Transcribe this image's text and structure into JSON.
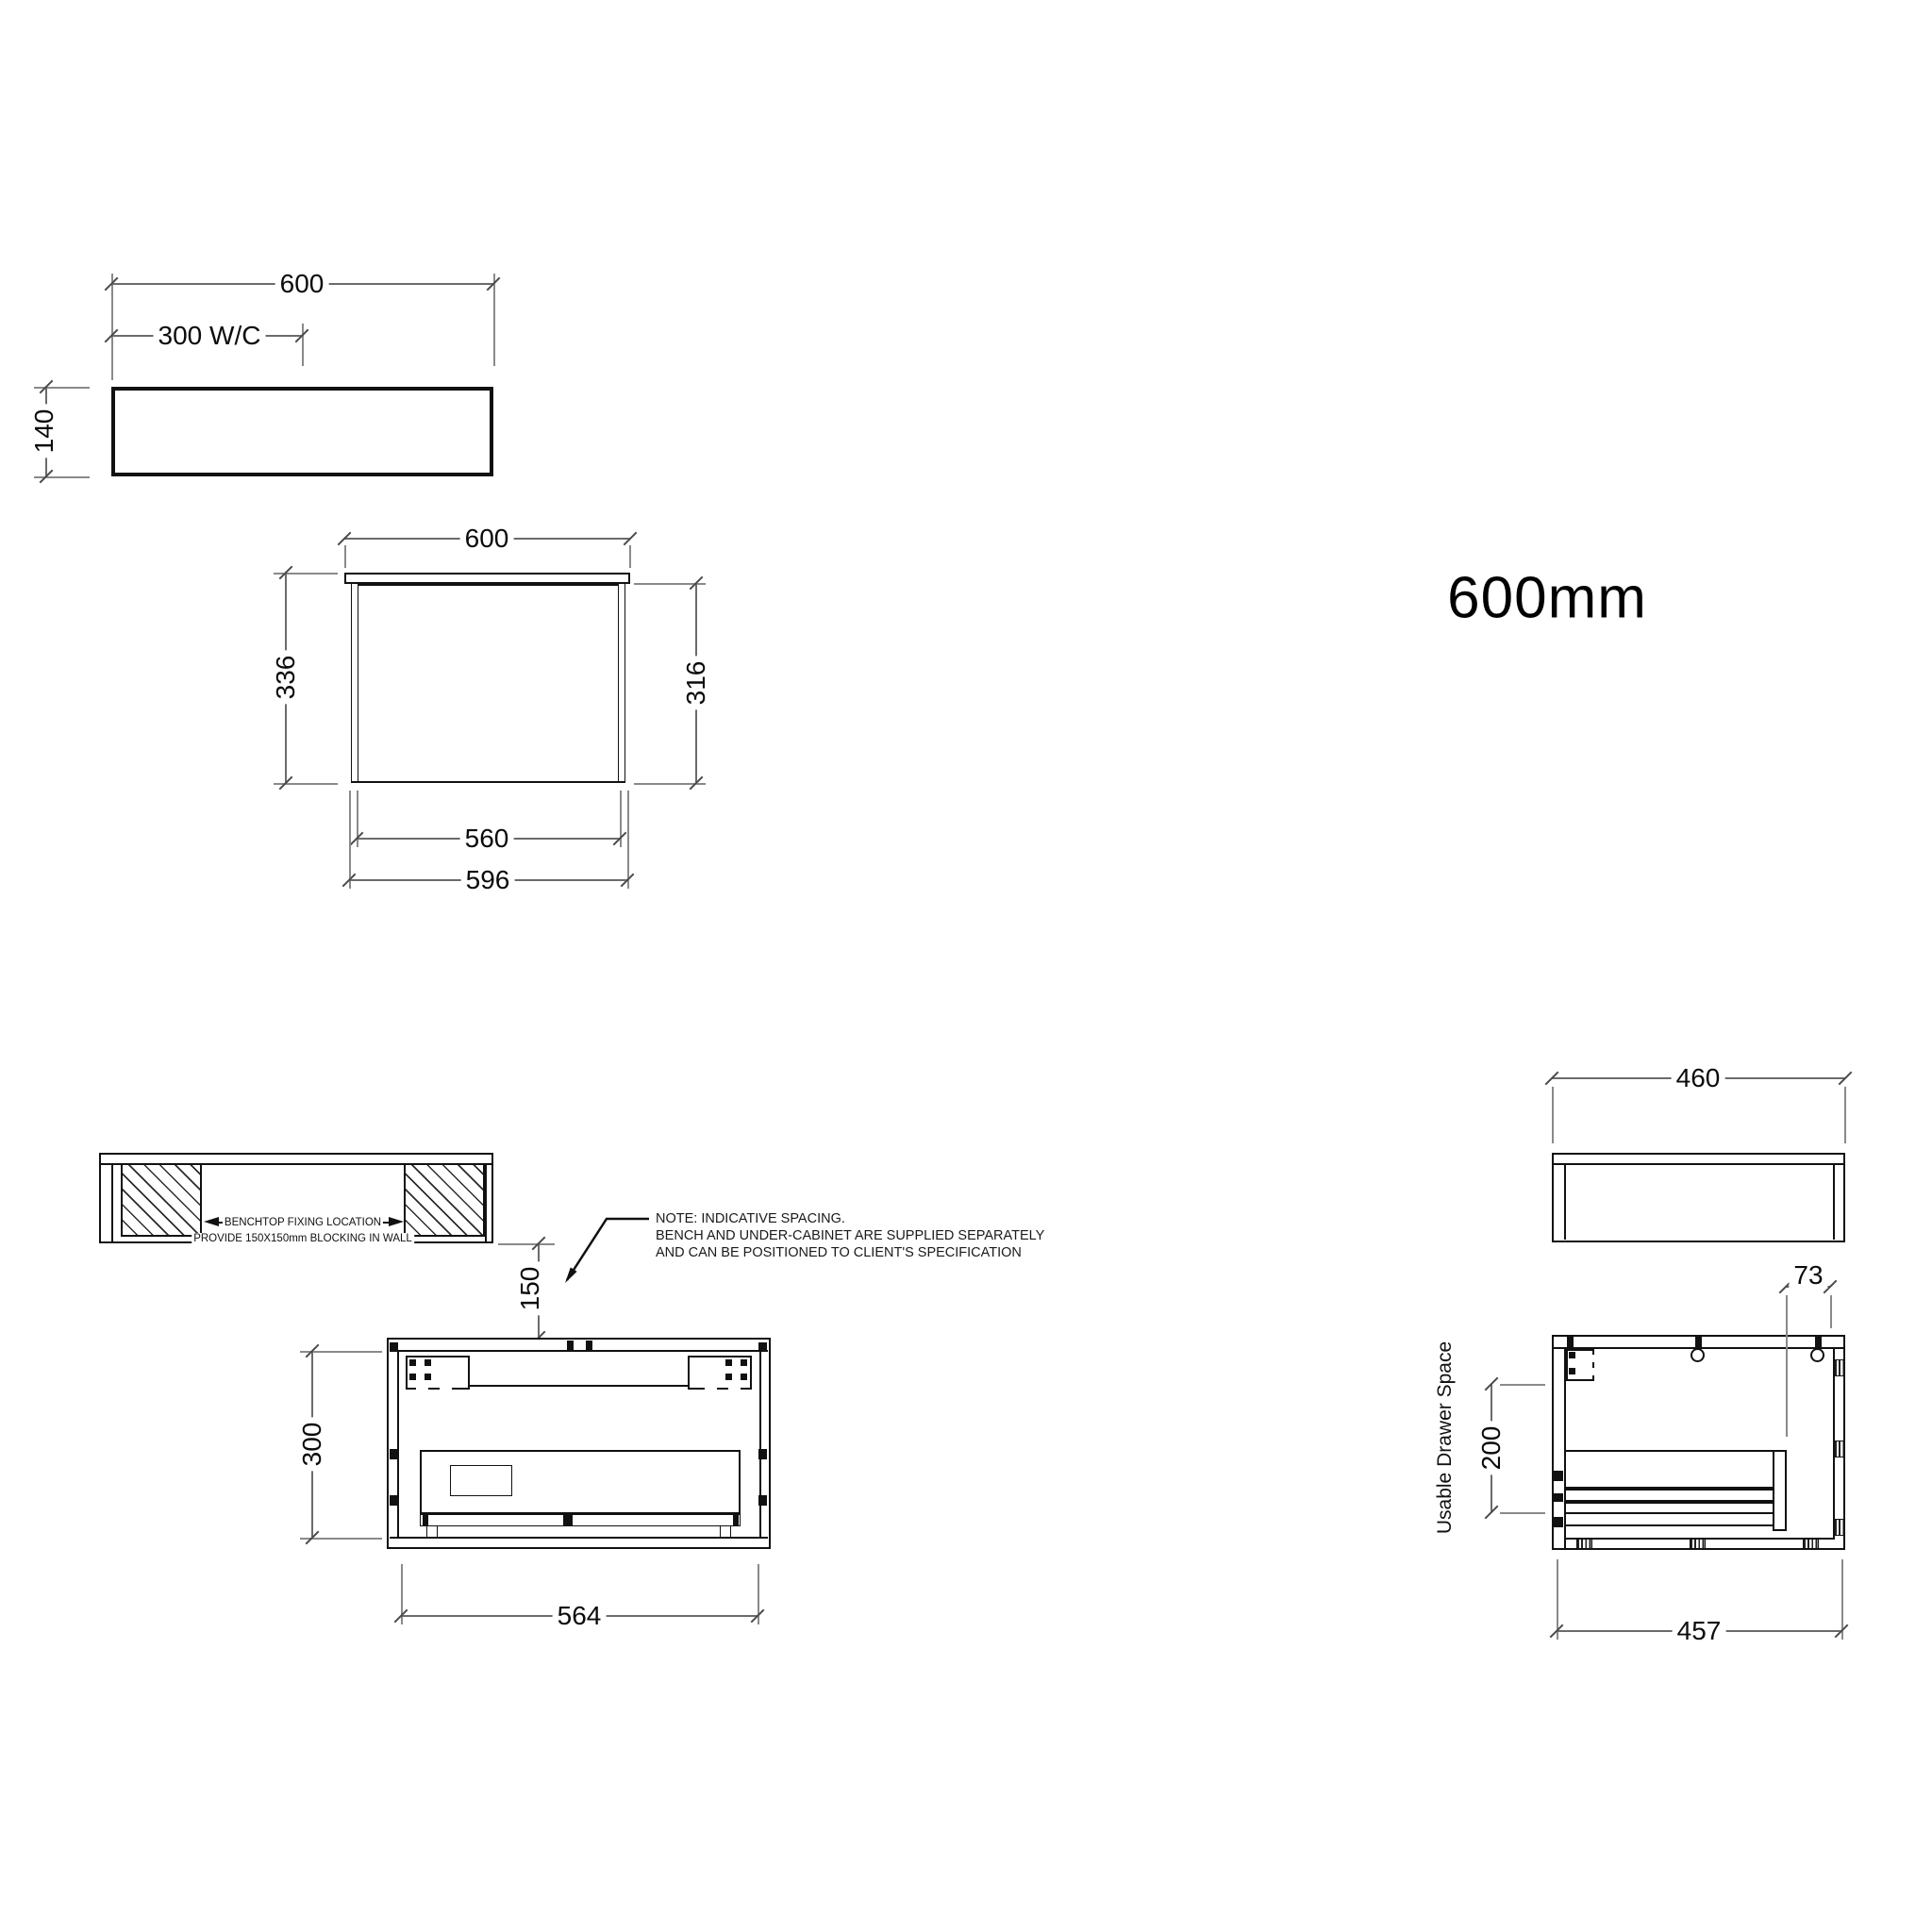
{
  "colors": {
    "line": "#111111",
    "dimension": "#6b6b6b"
  },
  "size_label": "600mm",
  "benchtop_plan": {
    "dim_width": "600",
    "dim_wc": "300 W/C",
    "dim_thickness": "140"
  },
  "front_elevation": {
    "dim_width": "600",
    "dim_height_overall": "336",
    "dim_height_cabinet": "316",
    "dim_inner_width": "560",
    "dim_outer_width": "596"
  },
  "wall_blocking": {
    "label_line1": "BENCHTOP FIXING LOCATION",
    "label_line2": "PROVIDE 150X150mm BLOCKING IN WALL",
    "dim_gap": "150"
  },
  "note": {
    "line1": "NOTE: INDICATIVE SPACING.",
    "line2": "BENCH AND UNDER-CABINET ARE SUPPLIED SEPARATELY",
    "line3": "AND CAN BE POSITIONED TO CLIENT'S SPECIFICATION"
  },
  "cabinet_plan": {
    "dim_depth": "300",
    "dim_width": "564"
  },
  "benchtop_side": {
    "dim_depth": "460"
  },
  "cabinet_side": {
    "dim_back_gap": "73",
    "dim_drawer_height": "200",
    "label_drawer": "Usable Drawer Space",
    "dim_depth": "457"
  }
}
